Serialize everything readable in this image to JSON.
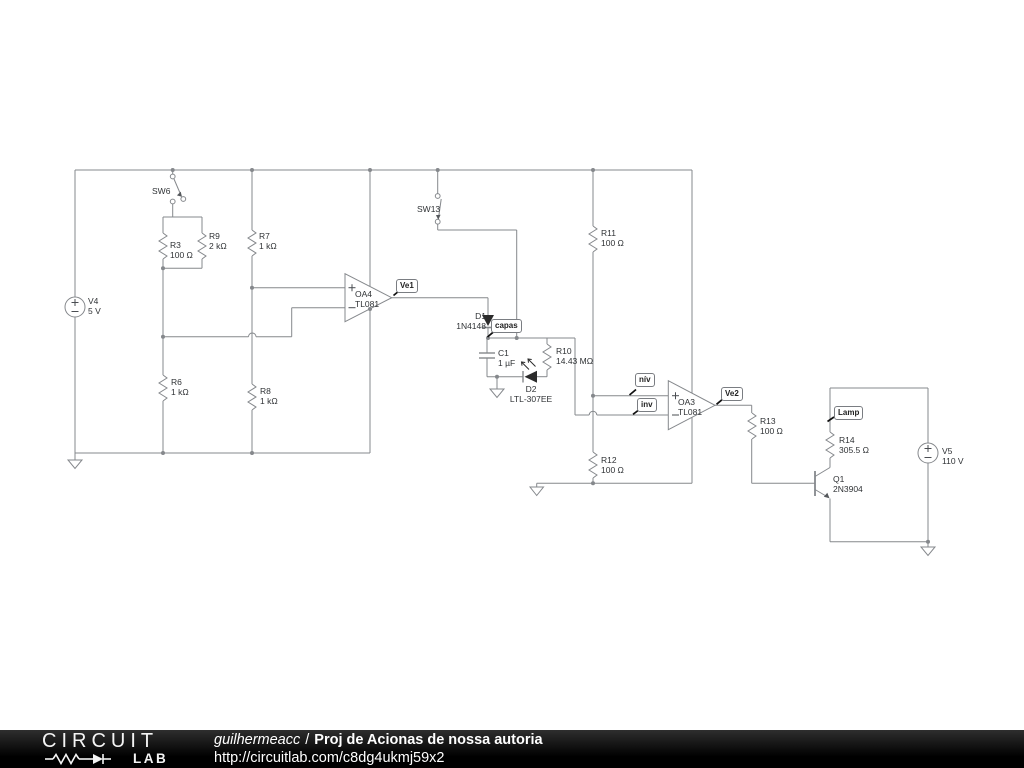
{
  "footer": {
    "logo_line1": "CIRCUIT",
    "logo_line2": "LAB",
    "username": "guilhermeacc",
    "separator": "/",
    "title": "Proj de Acionas de nossa autoria",
    "url": "http://circuitlab.com/c8dg4ukmj59x2"
  },
  "components": {
    "v4": {
      "name": "V4",
      "value": "5 V"
    },
    "sw6": {
      "name": "SW6"
    },
    "r3": {
      "name": "R3",
      "value": "100 Ω"
    },
    "r9": {
      "name": "R9",
      "value": "2 kΩ"
    },
    "r7": {
      "name": "R7",
      "value": "1 kΩ"
    },
    "r6": {
      "name": "R6",
      "value": "1 kΩ"
    },
    "r8": {
      "name": "R8",
      "value": "1 kΩ"
    },
    "oa4": {
      "name": "OA4",
      "value": "TL081"
    },
    "sw13": {
      "name": "SW13"
    },
    "d1": {
      "name": "D1",
      "value": "1N4148"
    },
    "c1": {
      "name": "C1",
      "value": "1 µF"
    },
    "r10": {
      "name": "R10",
      "value": "14.43 MΩ"
    },
    "d2": {
      "name": "D2",
      "value": "LTL-307EE"
    },
    "r11": {
      "name": "R11",
      "value": "100 Ω"
    },
    "r12": {
      "name": "R12",
      "value": "100 Ω"
    },
    "oa3": {
      "name": "OA3",
      "value": "TL081"
    },
    "r13": {
      "name": "R13",
      "value": "100 Ω"
    },
    "r14": {
      "name": "R14",
      "value": "305.5 Ω"
    },
    "q1": {
      "name": "Q1",
      "value": "2N3904"
    },
    "v5": {
      "name": "V5",
      "value": "110 V"
    }
  },
  "flags": {
    "ve1": "Ve1",
    "capas": "capas",
    "niv": "nív",
    "inv": "inv",
    "ve2": "Ve2",
    "lamp": "Lamp"
  },
  "colors": {
    "wire": "#85888c",
    "label_text": "#2f3235",
    "flag_border": "#7a7d82",
    "footer_bg": "#000000",
    "footer_text": "#ffffff"
  }
}
